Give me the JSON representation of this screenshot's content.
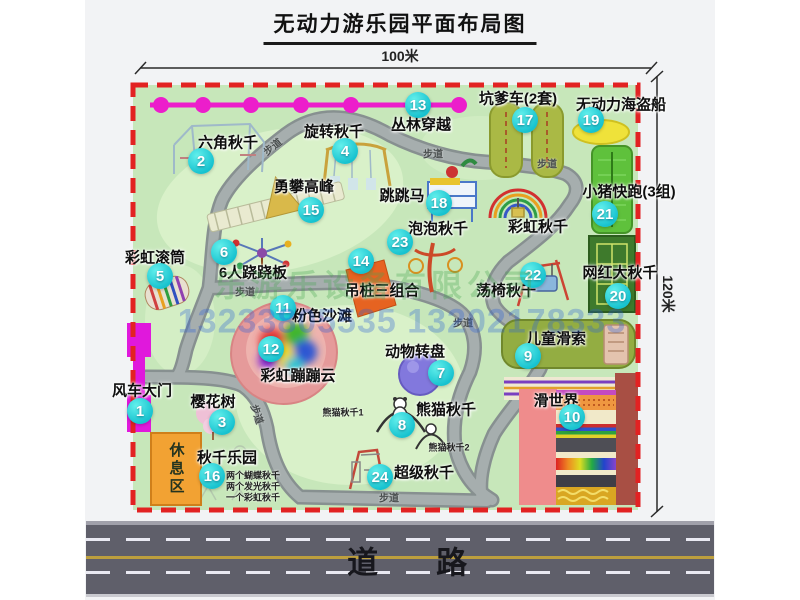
{
  "title": "无动力游乐园平面布局图",
  "dimensions": {
    "width_label": "100米",
    "height_label": "120米"
  },
  "road": {
    "label": "道路"
  },
  "rest_area": {
    "label": "休息区"
  },
  "watermark": {
    "company": "乐游乐设备有限公司",
    "phone": "13233805535 13202178333"
  },
  "trail_label": "步道",
  "colors": {
    "park_green": "#c7e7ba",
    "boundary_red": "#e22222",
    "marker_cyan": "#17c2cf",
    "gate_magenta": "#e018dc",
    "jungle_line_magenta": "#ec1ecb",
    "rest_orange": "#f2a233",
    "road_gray": "#5f5f6a",
    "road_yellow": "#bd9f3e"
  },
  "attractions": [
    {
      "num": "1",
      "name": "风车大门",
      "marker": {
        "x": 140,
        "y": 411
      },
      "label": {
        "x": 142,
        "y": 390
      }
    },
    {
      "num": "2",
      "name": "六角秋千",
      "marker": {
        "x": 201,
        "y": 161
      },
      "label": {
        "x": 228,
        "y": 142
      }
    },
    {
      "num": "3",
      "name": "樱花树",
      "marker": {
        "x": 222,
        "y": 422
      },
      "label": {
        "x": 213,
        "y": 401
      }
    },
    {
      "num": "4",
      "name": "旋转秋千",
      "marker": {
        "x": 345,
        "y": 151
      },
      "label": {
        "x": 334,
        "y": 131
      }
    },
    {
      "num": "5",
      "name": "彩虹滚筒",
      "marker": {
        "x": 160,
        "y": 276
      },
      "label": {
        "x": 155,
        "y": 257
      }
    },
    {
      "num": "6",
      "name": "6人跷跷板",
      "marker": {
        "x": 224,
        "y": 252
      },
      "label": {
        "x": 253,
        "y": 272
      }
    },
    {
      "num": "7",
      "name": "动物转盘",
      "marker": {
        "x": 441,
        "y": 373
      },
      "label": {
        "x": 415,
        "y": 351
      }
    },
    {
      "num": "8",
      "name": "熊猫秋千",
      "marker": {
        "x": 402,
        "y": 425
      },
      "label": {
        "x": 446,
        "y": 409
      }
    },
    {
      "num": "9",
      "name": "儿童滑索",
      "marker": {
        "x": 528,
        "y": 356
      },
      "label": {
        "x": 556,
        "y": 338
      }
    },
    {
      "num": "10",
      "name": "滑世界",
      "marker": {
        "x": 572,
        "y": 417
      },
      "label": {
        "x": 556,
        "y": 400
      }
    },
    {
      "num": "11",
      "name": "粉色沙滩",
      "marker": {
        "x": 283,
        "y": 308
      },
      "label": {
        "x": 322,
        "y": 315
      }
    },
    {
      "num": "12",
      "name": "彩虹蹦蹦云",
      "marker": {
        "x": 271,
        "y": 349
      },
      "label": {
        "x": 298,
        "y": 375
      }
    },
    {
      "num": "13",
      "name": "丛林穿越",
      "marker": {
        "x": 418,
        "y": 105
      },
      "label": {
        "x": 421,
        "y": 124
      }
    },
    {
      "num": "14",
      "name": "吊桩三组合",
      "marker": {
        "x": 361,
        "y": 261
      },
      "label": {
        "x": 382,
        "y": 290
      }
    },
    {
      "num": "15",
      "name": "勇攀高峰",
      "marker": {
        "x": 311,
        "y": 210
      },
      "label": {
        "x": 304,
        "y": 186
      }
    },
    {
      "num": "16",
      "name": "秋千乐园",
      "marker": {
        "x": 212,
        "y": 476
      },
      "label": {
        "x": 227,
        "y": 457
      }
    },
    {
      "num": "17",
      "name": "坑爹车(2套)",
      "marker": {
        "x": 525,
        "y": 120
      },
      "label": {
        "x": 518,
        "y": 98
      }
    },
    {
      "num": "18",
      "name": "跳跳马",
      "marker": {
        "x": 439,
        "y": 203
      },
      "label": {
        "x": 402,
        "y": 195
      }
    },
    {
      "num": "19",
      "name": "无动力海盗船",
      "marker": {
        "x": 591,
        "y": 120
      },
      "label": {
        "x": 621,
        "y": 104
      }
    },
    {
      "num": "20",
      "name": "网红大秋千",
      "marker": {
        "x": 618,
        "y": 296
      },
      "label": {
        "x": 620,
        "y": 272
      }
    },
    {
      "num": "21",
      "name": "小猪快跑(3组)",
      "marker": {
        "x": 605,
        "y": 214
      },
      "label": {
        "x": 629,
        "y": 191
      }
    },
    {
      "num": "22",
      "name": "荡椅秋千",
      "marker": {
        "x": 533,
        "y": 275
      },
      "label": {
        "x": 506,
        "y": 290
      }
    },
    {
      "num": "23",
      "name": "泡泡秋千",
      "marker": {
        "x": 400,
        "y": 242
      },
      "label": {
        "x": 438,
        "y": 228
      }
    },
    {
      "num": "24",
      "name": "超级秋千",
      "marker": {
        "x": 380,
        "y": 477
      },
      "label": {
        "x": 424,
        "y": 472
      }
    }
  ],
  "extra_labels": [
    {
      "text": "彩虹秋千",
      "x": 538,
      "y": 226
    }
  ],
  "sub_labels": [
    {
      "text": "熊猫秋千1",
      "x": 343,
      "y": 412
    },
    {
      "text": "熊猫秋千2",
      "x": 449,
      "y": 447
    },
    {
      "text": "两个蝴蝶秋千",
      "x": 253,
      "y": 475
    },
    {
      "text": "两个发光秋千",
      "x": 253,
      "y": 486
    },
    {
      "text": "一个彩虹秋千",
      "x": 253,
      "y": 497
    }
  ],
  "trail_labels": [
    {
      "x": 272,
      "y": 146,
      "rot": -38
    },
    {
      "x": 433,
      "y": 153,
      "rot": 0
    },
    {
      "x": 547,
      "y": 163,
      "rot": 0
    },
    {
      "x": 245,
      "y": 291,
      "rot": 0
    },
    {
      "x": 463,
      "y": 322,
      "rot": 0
    },
    {
      "x": 258,
      "y": 414,
      "rot": 72
    },
    {
      "x": 389,
      "y": 497,
      "rot": 0
    }
  ]
}
